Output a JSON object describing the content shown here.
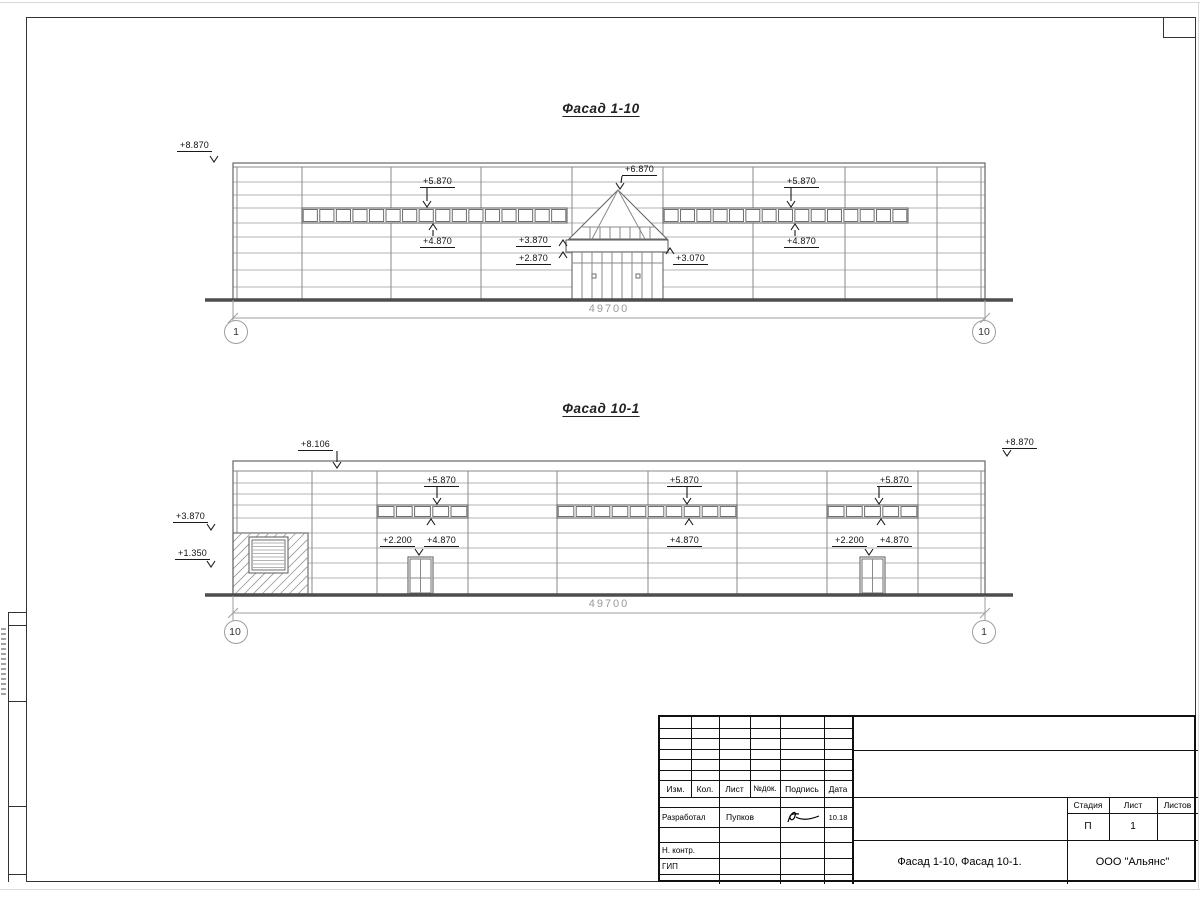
{
  "facades": [
    {
      "title": "Фасад 1-10",
      "dimension": "49700",
      "axis_left": "1",
      "axis_right": "10",
      "marks": [
        "+8.870",
        "+5.870",
        "+4.870",
        "+6.870",
        "+3.870",
        "+2.870",
        "+3.070",
        "+5.870",
        "+4.870"
      ]
    },
    {
      "title": "Фасад 10-1",
      "dimension": "49700",
      "axis_left": "10",
      "axis_right": "1",
      "marks": [
        "+8.106",
        "+8.870",
        "+3.870",
        "+1.350",
        "+5.870",
        "+2.200",
        "+4.870",
        "+5.870",
        "+4.870",
        "+5.870",
        "+2.200",
        "+4.870"
      ]
    }
  ],
  "title_block": {
    "header_cols": [
      "Изм.",
      "Кол.",
      "Лист",
      "№док.",
      "Подпись",
      "Дата"
    ],
    "developed_label": "Разработал",
    "developed_name": "Пупков",
    "developed_date": "10.18",
    "ncontrol_label": "Н. контр.",
    "gip_label": "ГИП",
    "stage_label": "Стадия",
    "sheet_label": "Лист",
    "sheets_label": "Листов",
    "stage_value": "П",
    "sheet_value": "1",
    "sheets_value": "",
    "doc_title": "Фасад 1-10, Фасад 10-1.",
    "organization": "ООО \"Альянс\""
  }
}
